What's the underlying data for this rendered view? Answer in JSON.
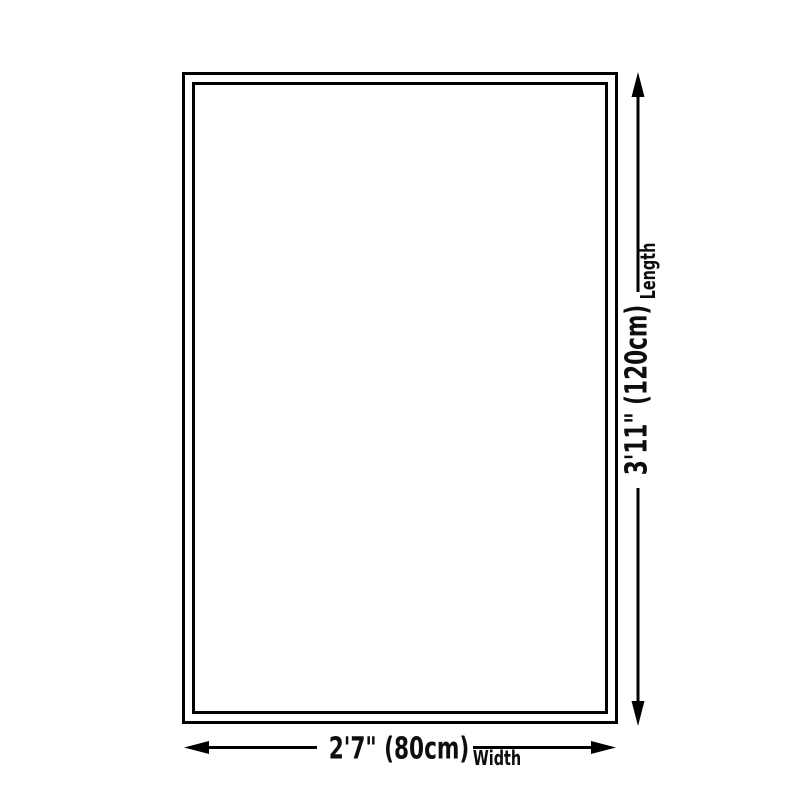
{
  "diagram": {
    "length": {
      "value": "3'11\" (120cm)",
      "label": "Length"
    },
    "width": {
      "value": "2'7\" (80cm)",
      "label": "Width"
    },
    "colors": {
      "line": "#000000",
      "text": "#0d0d0d",
      "background": "#ffffff"
    }
  }
}
